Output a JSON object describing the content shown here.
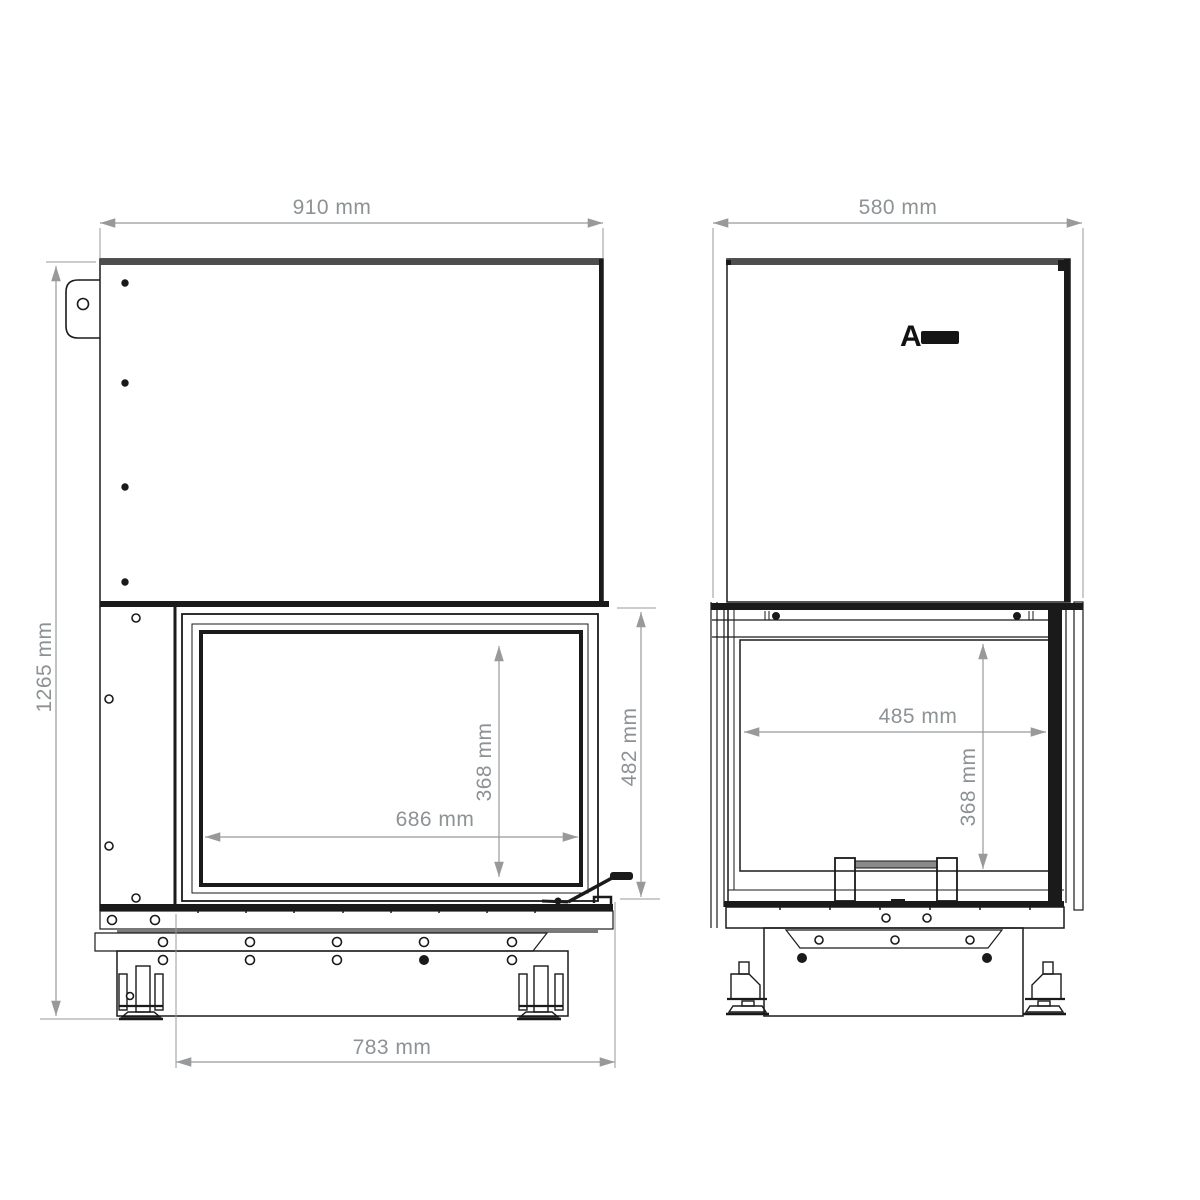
{
  "colors": {
    "line": "#1a1a1a",
    "dimension": "#97999b",
    "dim-text": "#8d9295",
    "band": "#4e4e4e",
    "metal": "#8a8a8a"
  },
  "front_view": {
    "dimensions": {
      "width": "910 mm",
      "height": "1265 mm",
      "glass_width": "686 mm",
      "glass_height": "368 mm",
      "door_height": "482 mm",
      "base_width": "783 mm"
    }
  },
  "side_view": {
    "dimensions": {
      "depth": "580 mm",
      "firebox_depth": "485 mm",
      "firebox_height": "368 mm"
    },
    "brand_logo_letter": "A"
  }
}
